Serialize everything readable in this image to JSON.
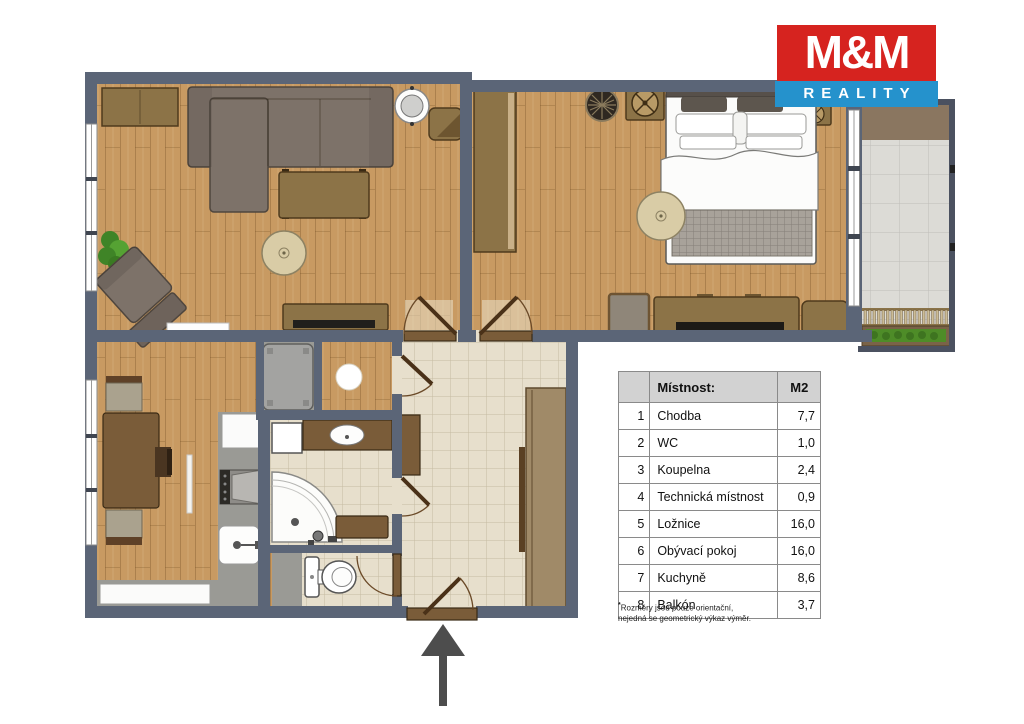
{
  "logo": {
    "line1": "M&M",
    "line2": "REALITY"
  },
  "room_table": {
    "headers": {
      "room": "Místnost:",
      "area": "M2"
    },
    "rows": [
      {
        "num": "1",
        "name": "Chodba",
        "area": "7,7"
      },
      {
        "num": "2",
        "name": "WC",
        "area": "1,0"
      },
      {
        "num": "3",
        "name": "Koupelna",
        "area": "2,4"
      },
      {
        "num": "4",
        "name": "Technická místnost",
        "area": "0,9"
      },
      {
        "num": "5",
        "name": "Ložnice",
        "area": "16,0"
      },
      {
        "num": "6",
        "name": "Obývací pokoj",
        "area": "16,0"
      },
      {
        "num": "7",
        "name": "Kuchyně",
        "area": "8,6"
      },
      {
        "num": "8",
        "name": "Balkón",
        "area": "3,7"
      }
    ],
    "footnote_mark": "*",
    "footnote_line1": "Rozměry jsou pouze orientační,",
    "footnote_line2": "nejedná se geometrický výkaz výměr."
  },
  "icons": {
    "entrance_arrow": "up-arrow"
  },
  "colors": {
    "wall": "#5b6577",
    "wall_thin": "#4b5160",
    "wood": "#c89a62",
    "tile": "#e7dfcc",
    "balcony_tile": "#dcdbd6",
    "counter": "#9a9a95",
    "sofa": "#7d7269",
    "furniture_brown": "#8c7347",
    "furniture_dark_brown": "#7a5c39",
    "rug": "#d9cca6",
    "plant": "#3f8427",
    "logo_red": "#d6231f",
    "logo_blue": "#2592cc",
    "arrow": "#4d4d4d",
    "table_header_bg": "#d2d2d2",
    "table_border": "#8a8a8a"
  }
}
